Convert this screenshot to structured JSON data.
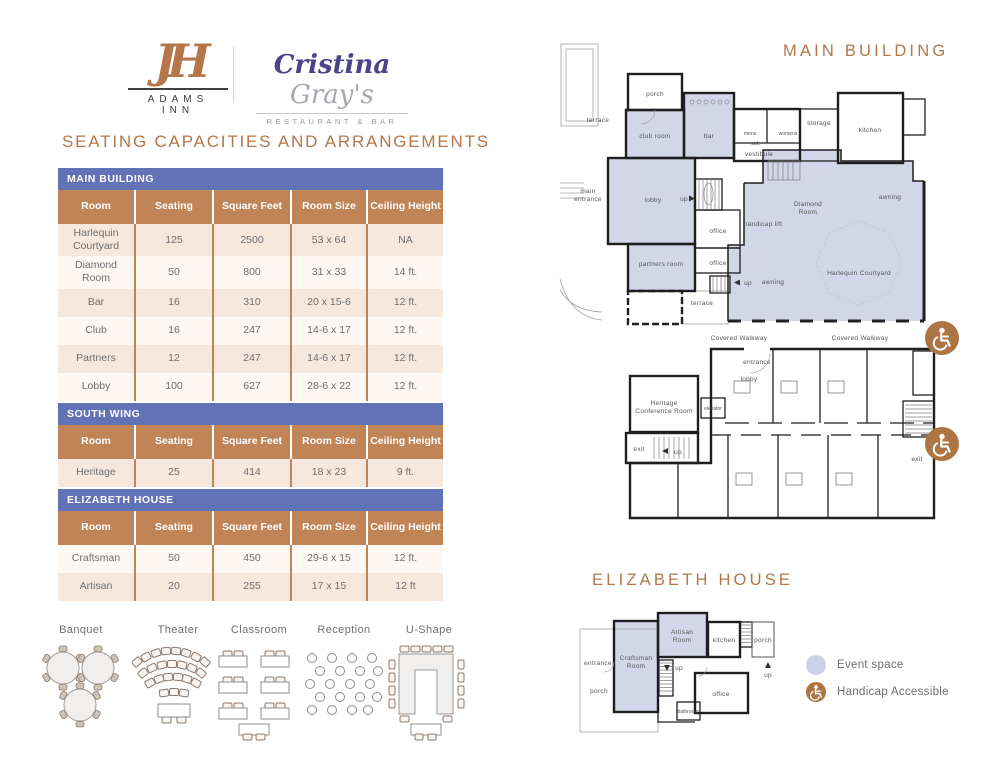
{
  "brand": {
    "monogram": "JH",
    "hotel_name": "ADAMS INN",
    "restaurant_script_1": "Cristina",
    "restaurant_script_2": "Gray's",
    "restaurant_tagline": "RESTAURANT & BAR"
  },
  "page_title": "SEATING CAPACITIES AND ARRANGEMENTS",
  "capacity_table": {
    "columns": [
      "Room",
      "Seating",
      "Square Feet",
      "Room Size",
      "Ceiling Height"
    ],
    "sections": [
      {
        "name": "MAIN BUILDING",
        "rows": [
          [
            "Harlequin Courtyard",
            "125",
            "2500",
            "53 x 64",
            "NA"
          ],
          [
            "Diamond Room",
            "50",
            "800",
            "31 x 33",
            "14 ft."
          ],
          [
            "Bar",
            "16",
            "310",
            "20 x 15-6",
            "12 ft."
          ],
          [
            "Club",
            "16",
            "247",
            "14-6 x 17",
            "12 ft."
          ],
          [
            "Partners",
            "12",
            "247",
            "14-6 x 17",
            "12 ft."
          ],
          [
            "Lobby",
            "100",
            "627",
            "28-6 x 22",
            "12 ft."
          ]
        ]
      },
      {
        "name": "SOUTH WING",
        "rows": [
          [
            "Heritage",
            "25",
            "414",
            "18 x 23",
            "9 ft."
          ]
        ]
      },
      {
        "name": "ELIZABETH HOUSE",
        "rows": [
          [
            "Craftsman",
            "50",
            "450",
            "29-6 x 15",
            "12 ft."
          ],
          [
            "Artisan",
            "20",
            "255",
            "17 x 15",
            "12 ft"
          ]
        ]
      }
    ]
  },
  "arrangements": {
    "labels": [
      "Banquet",
      "Theater",
      "Classroom",
      "Reception",
      "U-Shape"
    ]
  },
  "floor_plans": {
    "main_title": "MAIN BUILDING",
    "elizabeth_title": "ELIZABETH HOUSE",
    "labels": {
      "porch": "porch",
      "terrace": "terrace",
      "club_room": "club room",
      "bar": "bar",
      "mens": "mens",
      "womens": "womens",
      "cafe": "cafe",
      "vestibule": "vestibule",
      "storage": "storage",
      "kitchen": "kitchen",
      "main_entrance_1": "main",
      "main_entrance_2": "entrance",
      "lobby": "lobby",
      "up": "up",
      "office": "office",
      "partners_room": "partners room",
      "handicap_lift": "handicap lift",
      "diamond_1": "Diamond",
      "diamond_2": "Room",
      "awning": "awning",
      "harlequin": "Harlequin Courtyard",
      "covered_walkway": "Covered Walkway",
      "entrance": "entrance",
      "heritage_1": "Heritage",
      "heritage_2": "Conference Room",
      "elevator": "elevator",
      "exit": "exit",
      "craftsman_1": "Craftsman",
      "craftsman_2": "Room",
      "artisan_1": "Artisan",
      "artisan_2": "Room",
      "bathroom": "bathroom"
    }
  },
  "legend": {
    "event_space": "Event space",
    "handicap_accessible": "Handicap Accessible"
  },
  "colors": {
    "accent_brown": "#b5764a",
    "table_header_brown": "#c08457",
    "band_purple": "#6172b6",
    "row_tan": "#f6e8dd",
    "row_light": "#fdf8f4",
    "event_space_lavender": "#d3d5e9",
    "handicap_icon_brown": "#ad7444"
  }
}
